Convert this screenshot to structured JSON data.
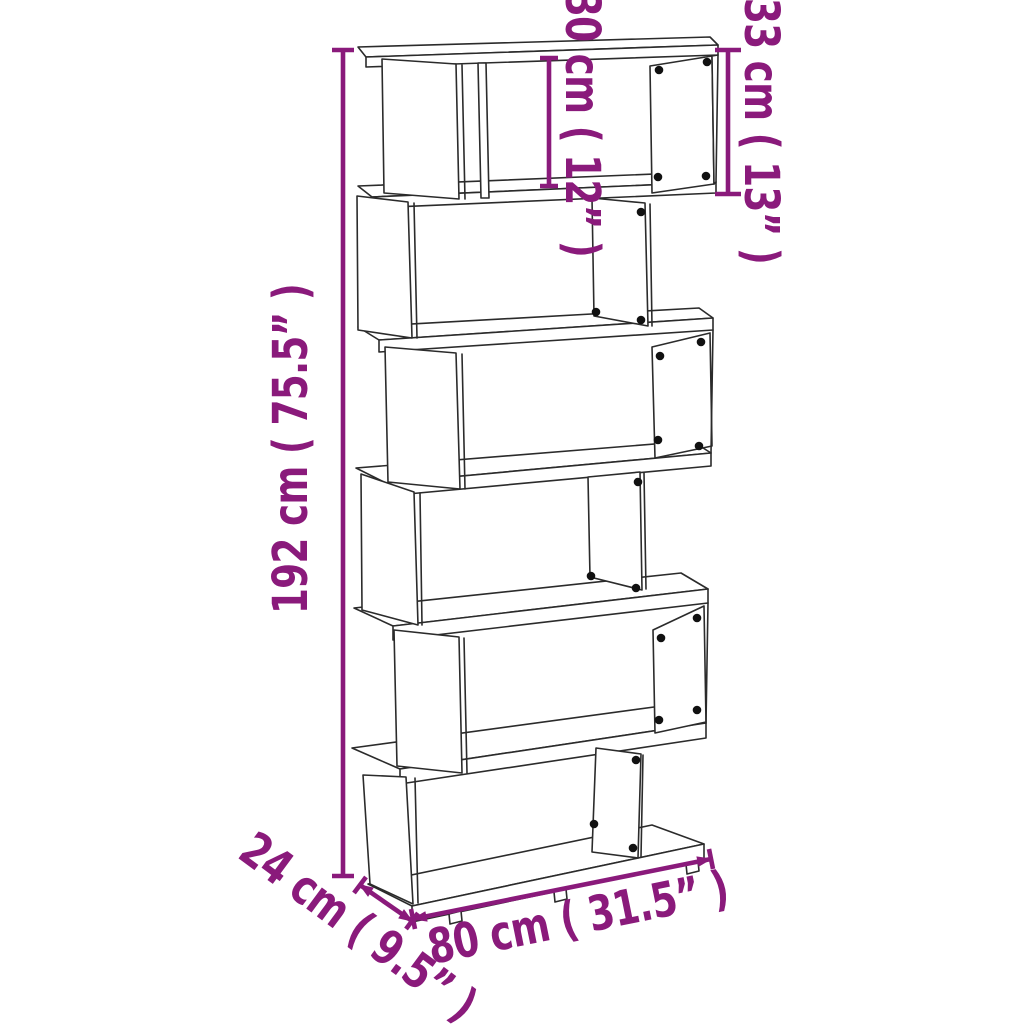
{
  "diagram": {
    "background_color": "#ffffff",
    "line_art_color": "#2b2b2b",
    "dimension_accent_color": "#8a1a7b",
    "shelf_tiers": 6,
    "dimensions": {
      "height": "192 cm ( 75.5” )",
      "compartment_inner_height": "30 cm ( 12” )",
      "top_tier_height": "33 cm ( 13” )",
      "depth": "24 cm ( 9.5” )",
      "width": "80 cm ( 31.5” )"
    }
  }
}
